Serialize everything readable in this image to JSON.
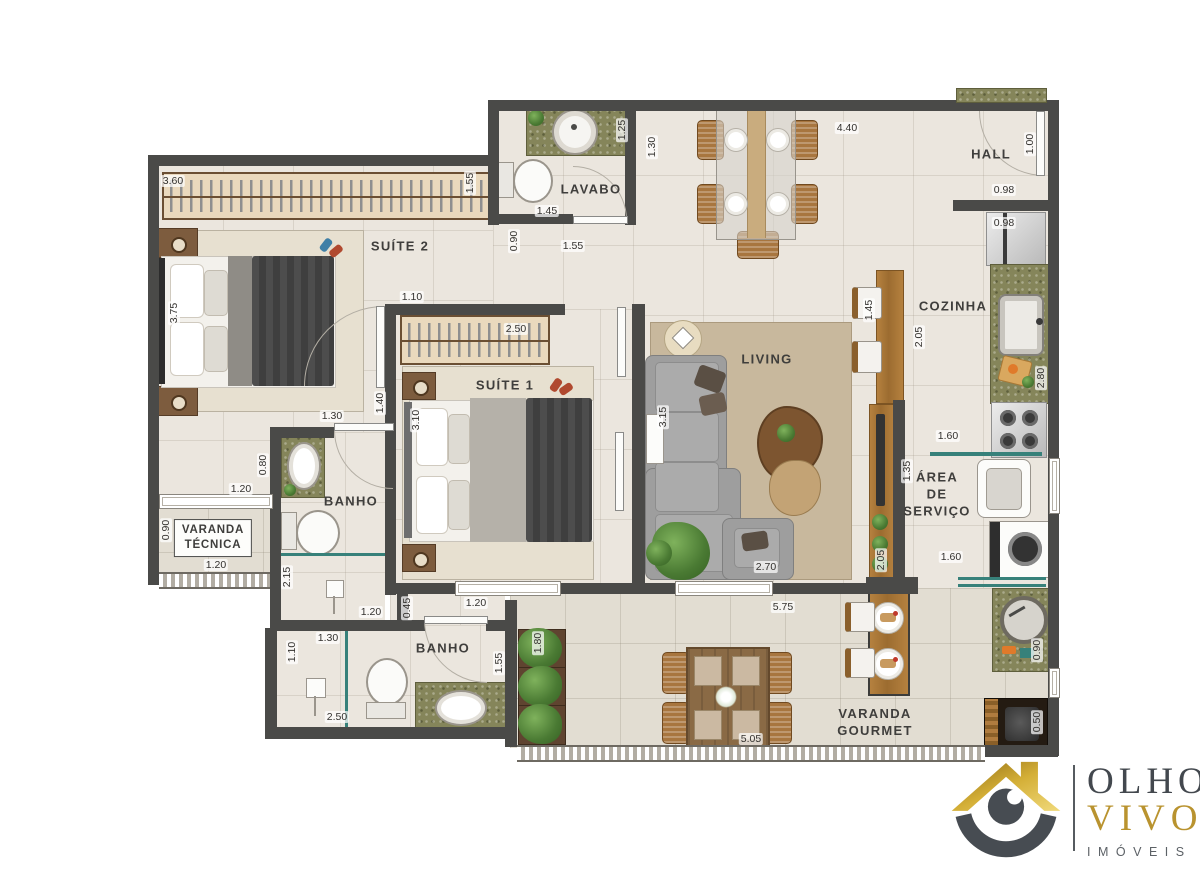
{
  "logo": {
    "line1": "OLHO",
    "line2": "VIVO",
    "dot": ".",
    "registered": "®",
    "line3": "IMÓVEIS"
  },
  "rooms": [
    {
      "id": "suite2",
      "label": "SUÍTE 2",
      "x": 400,
      "y": 247
    },
    {
      "id": "suite1",
      "label": "SUÍTE 1",
      "x": 505,
      "y": 386
    },
    {
      "id": "lavabo",
      "label": "LAVABO",
      "x": 591,
      "y": 190
    },
    {
      "id": "living",
      "label": "LIVING",
      "x": 767,
      "y": 360
    },
    {
      "id": "cozinha",
      "label": "COZINHA",
      "x": 953,
      "y": 307
    },
    {
      "id": "hall",
      "label": "HALL",
      "x": 991,
      "y": 155
    },
    {
      "id": "banho-suite1",
      "label": "BANHO",
      "x": 351,
      "y": 502
    },
    {
      "id": "banho-suite2",
      "label": "BANHO",
      "x": 443,
      "y": 649
    },
    {
      "id": "area-servico",
      "label": "ÁREA\nDE\nSERVIÇO",
      "x": 937,
      "y": 495
    },
    {
      "id": "varanda-gourmet",
      "label": "VARANDA\nGOURMET",
      "x": 875,
      "y": 723
    },
    {
      "id": "varanda-tecnica",
      "label": "VARANDA\nTÉCNICA",
      "x": 213,
      "y": 538,
      "boxed": true
    }
  ],
  "dims": [
    {
      "t": "3.60",
      "x": 173,
      "y": 181,
      "v": false
    },
    {
      "t": "1.55",
      "x": 470,
      "y": 183,
      "v": true
    },
    {
      "t": "3.75",
      "x": 174,
      "y": 313,
      "v": true
    },
    {
      "t": "1.10",
      "x": 412,
      "y": 297,
      "v": false
    },
    {
      "t": "1.40",
      "x": 380,
      "y": 403,
      "v": true
    },
    {
      "t": "1.30",
      "x": 332,
      "y": 416,
      "v": false
    },
    {
      "t": "2.50",
      "x": 516,
      "y": 329,
      "v": false
    },
    {
      "t": "3.10",
      "x": 416,
      "y": 420,
      "v": true
    },
    {
      "t": "1.45",
      "x": 547,
      "y": 211,
      "v": false
    },
    {
      "t": "1.25",
      "x": 622,
      "y": 130,
      "v": true
    },
    {
      "t": "0.90",
      "x": 514,
      "y": 241,
      "v": true
    },
    {
      "t": "1.55",
      "x": 573,
      "y": 246,
      "v": false
    },
    {
      "t": "1.30",
      "x": 652,
      "y": 147,
      "v": true
    },
    {
      "t": "4.40",
      "x": 847,
      "y": 128,
      "v": false
    },
    {
      "t": "1.00",
      "x": 1030,
      "y": 144,
      "v": true
    },
    {
      "t": "0.98",
      "x": 1004,
      "y": 190,
      "v": false
    },
    {
      "t": "0.98",
      "x": 1004,
      "y": 223,
      "v": false
    },
    {
      "t": "2.05",
      "x": 919,
      "y": 337,
      "v": true
    },
    {
      "t": "1.45",
      "x": 869,
      "y": 310,
      "v": true
    },
    {
      "t": "2.80",
      "x": 1041,
      "y": 378,
      "v": true
    },
    {
      "t": "1.60",
      "x": 948,
      "y": 436,
      "v": false
    },
    {
      "t": "1.35",
      "x": 907,
      "y": 471,
      "v": true
    },
    {
      "t": "1.60",
      "x": 951,
      "y": 557,
      "v": false
    },
    {
      "t": "2.05",
      "x": 881,
      "y": 560,
      "v": true
    },
    {
      "t": "3.15",
      "x": 663,
      "y": 417,
      "v": true
    },
    {
      "t": "2.70",
      "x": 766,
      "y": 567,
      "v": false
    },
    {
      "t": "0.80",
      "x": 263,
      "y": 465,
      "v": true
    },
    {
      "t": "1.20",
      "x": 241,
      "y": 489,
      "v": false
    },
    {
      "t": "0.90",
      "x": 166,
      "y": 530,
      "v": true
    },
    {
      "t": "1.20",
      "x": 216,
      "y": 565,
      "v": false
    },
    {
      "t": "2.15",
      "x": 287,
      "y": 577,
      "v": true
    },
    {
      "t": "1.20",
      "x": 371,
      "y": 612,
      "v": false
    },
    {
      "t": "0.45",
      "x": 407,
      "y": 608,
      "v": true
    },
    {
      "t": "1.20",
      "x": 476,
      "y": 603,
      "v": false
    },
    {
      "t": "1.30",
      "x": 328,
      "y": 638,
      "v": false
    },
    {
      "t": "1.10",
      "x": 292,
      "y": 652,
      "v": true
    },
    {
      "t": "2.50",
      "x": 337,
      "y": 717,
      "v": false
    },
    {
      "t": "1.55",
      "x": 499,
      "y": 663,
      "v": true
    },
    {
      "t": "1.80",
      "x": 538,
      "y": 643,
      "v": true
    },
    {
      "t": "5.75",
      "x": 783,
      "y": 607,
      "v": false
    },
    {
      "t": "5.05",
      "x": 751,
      "y": 739,
      "v": false
    },
    {
      "t": "0.90",
      "x": 1037,
      "y": 650,
      "v": true
    },
    {
      "t": "0.50",
      "x": 1037,
      "y": 722,
      "v": true
    }
  ]
}
